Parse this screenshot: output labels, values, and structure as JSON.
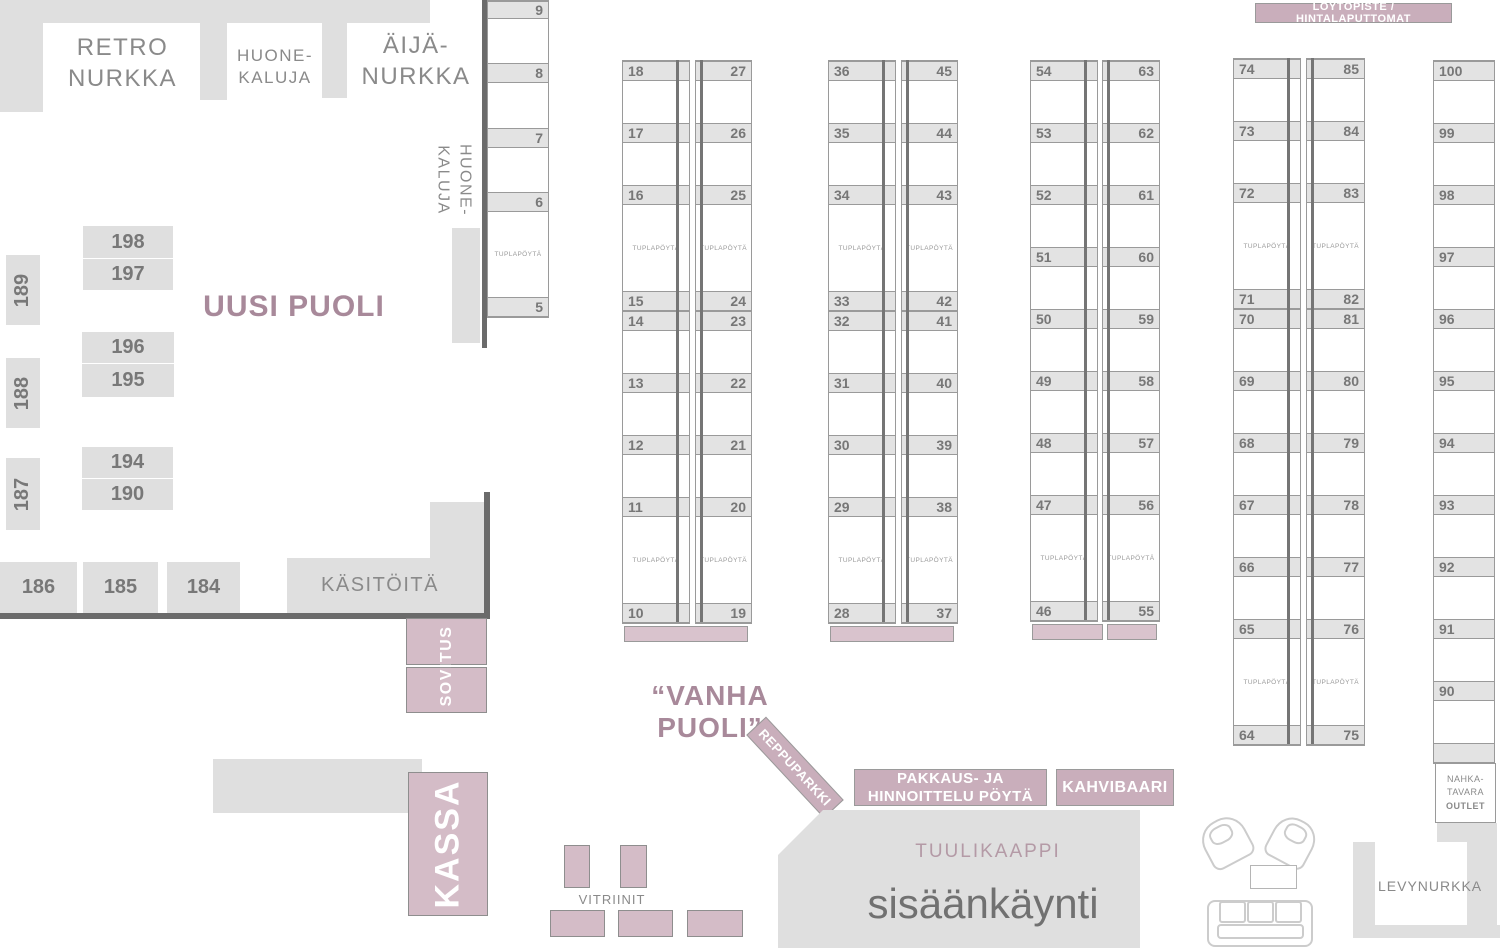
{
  "palette": {
    "pink_fill": "#d4bcc7",
    "badge_pink": "#c9aebb",
    "bar_pink": "#d9c3cd",
    "gray_fill": "#dfdfdf",
    "band_gray": "#e3e3e3",
    "line_gray": "#9a9a9a",
    "dark_wall": "#6b6b6b",
    "text_gray": "#8a8a8a",
    "mauve": "#a8899a"
  },
  "labels": {
    "retro": [
      "RETRO",
      "NURKKA"
    ],
    "huonekaluja_top": [
      "HUONE-",
      "KALUJA"
    ],
    "aija": [
      "ÄIJÄ-",
      "NURKKA"
    ],
    "huonekaluja_side": [
      "HUONE-",
      "KALUJA"
    ],
    "uusi_puoli": "UUSI PUOLI",
    "vanha_puoli": "“VANHA PUOLI”",
    "kasitoita": "KÄSITÖITÄ",
    "sovitus": "SOVITUS",
    "kassa": "KASSA",
    "vitriinit": "VITRIINIT",
    "reppuparkki": "REPPUPARKKI",
    "pakkaus": [
      "PAKKAUS- JA",
      "HINNOITTELU PÖYTÄ"
    ],
    "kahvibaari": "KAHVIBAARI",
    "tuulikaappi": "TUULIKAAPPI",
    "sisaankaynti": "sisäänkäynti",
    "loytopiste": "LÖYTÖPISTE / HINTALAPUTTOMAT",
    "nahka": [
      "NAHKA-",
      "TAVARA",
      "OUTLET"
    ],
    "levynurkka": "LEVYNURKKA"
  },
  "tupla_label": "TUPLAPÖYTÄ",
  "booths": {
    "vertical": [
      {
        "num": "189",
        "x": 6,
        "y": 255,
        "w": 34,
        "h": 70
      },
      {
        "num": "188",
        "x": 6,
        "y": 358,
        "w": 34,
        "h": 70
      },
      {
        "num": "187",
        "x": 6,
        "y": 458,
        "w": 34,
        "h": 72
      }
    ],
    "horizontal": [
      {
        "num": "198",
        "x": 83,
        "y": 226,
        "w": 90,
        "h": 32
      },
      {
        "num": "197",
        "x": 83,
        "y": 259,
        "w": 90,
        "h": 31
      },
      {
        "num": "196",
        "x": 82,
        "y": 332,
        "w": 92,
        "h": 31
      },
      {
        "num": "195",
        "x": 82,
        "y": 364,
        "w": 92,
        "h": 33
      },
      {
        "num": "194",
        "x": 82,
        "y": 447,
        "w": 91,
        "h": 31
      },
      {
        "num": "190",
        "x": 82,
        "y": 479,
        "w": 91,
        "h": 31
      },
      {
        "num": "186",
        "x": 0,
        "y": 562,
        "w": 77,
        "h": 51
      },
      {
        "num": "185",
        "x": 83,
        "y": 562,
        "w": 75,
        "h": 51
      },
      {
        "num": "184",
        "x": 167,
        "y": 562,
        "w": 73,
        "h": 51
      }
    ]
  },
  "table_columns": [
    {
      "name": "tables-5-9",
      "x": 487,
      "y": 0,
      "mode": "single-right",
      "colw": 60,
      "segments": [
        {
          "t": "b",
          "n": "9",
          "h": 18
        },
        {
          "t": "g",
          "h": 44
        },
        {
          "t": "b",
          "n": "8"
        },
        {
          "t": "g",
          "h": 45
        },
        {
          "t": "b",
          "n": "7"
        },
        {
          "t": "g",
          "h": 44
        },
        {
          "t": "b",
          "n": "6"
        },
        {
          "t": "d",
          "h": 85
        },
        {
          "t": "b",
          "n": "5"
        }
      ]
    },
    {
      "name": "tables-10-27",
      "x": 622,
      "y": 60,
      "mode": "double",
      "lw": 66,
      "gap": 7,
      "rw": 55,
      "segments": [
        {
          "t": "b",
          "l": "18",
          "r": "27"
        },
        {
          "t": "g"
        },
        {
          "t": "b",
          "l": "17",
          "r": "26"
        },
        {
          "t": "g"
        },
        {
          "t": "b",
          "l": "16",
          "r": "25"
        },
        {
          "t": "d"
        },
        {
          "t": "b",
          "l": "15",
          "r": "24"
        },
        {
          "t": "b",
          "l": "14",
          "r": "23"
        },
        {
          "t": "g"
        },
        {
          "t": "b",
          "l": "13",
          "r": "22"
        },
        {
          "t": "g"
        },
        {
          "t": "b",
          "l": "12",
          "r": "21"
        },
        {
          "t": "g"
        },
        {
          "t": "b",
          "l": "11",
          "r": "20"
        },
        {
          "t": "d"
        },
        {
          "t": "b",
          "l": "10",
          "r": "19"
        }
      ],
      "bars": [
        {
          "x": 2,
          "w": 124
        }
      ]
    },
    {
      "name": "tables-28-45",
      "x": 828,
      "y": 60,
      "mode": "double",
      "lw": 66,
      "gap": 7,
      "rw": 55,
      "segments": [
        {
          "t": "b",
          "l": "36",
          "r": "45"
        },
        {
          "t": "g"
        },
        {
          "t": "b",
          "l": "35",
          "r": "44"
        },
        {
          "t": "g"
        },
        {
          "t": "b",
          "l": "34",
          "r": "43"
        },
        {
          "t": "d"
        },
        {
          "t": "b",
          "l": "33",
          "r": "42"
        },
        {
          "t": "b",
          "l": "32",
          "r": "41"
        },
        {
          "t": "g"
        },
        {
          "t": "b",
          "l": "31",
          "r": "40"
        },
        {
          "t": "g"
        },
        {
          "t": "b",
          "l": "30",
          "r": "39"
        },
        {
          "t": "g"
        },
        {
          "t": "b",
          "l": "29",
          "r": "38"
        },
        {
          "t": "d"
        },
        {
          "t": "b",
          "l": "28",
          "r": "37"
        }
      ],
      "bars": [
        {
          "x": 2,
          "w": 124
        }
      ]
    },
    {
      "name": "tables-46-63",
      "x": 1030,
      "y": 60,
      "mode": "double",
      "lw": 66,
      "gap": 6,
      "rw": 56,
      "segments": [
        {
          "t": "b",
          "l": "54",
          "r": "63"
        },
        {
          "t": "g"
        },
        {
          "t": "b",
          "l": "53",
          "r": "62"
        },
        {
          "t": "g"
        },
        {
          "t": "b",
          "l": "52",
          "r": "61"
        },
        {
          "t": "g"
        },
        {
          "t": "b",
          "l": "51",
          "r": "60"
        },
        {
          "t": "g"
        },
        {
          "t": "b",
          "l": "50",
          "r": "59"
        },
        {
          "t": "g"
        },
        {
          "t": "b",
          "l": "49",
          "r": "58"
        },
        {
          "t": "g"
        },
        {
          "t": "b",
          "l": "48",
          "r": "57"
        },
        {
          "t": "g"
        },
        {
          "t": "b",
          "l": "47",
          "r": "56"
        },
        {
          "t": "d"
        },
        {
          "t": "b",
          "l": "46",
          "r": "55"
        }
      ],
      "bars": [
        {
          "x": 2,
          "w": 71
        },
        {
          "x": 77,
          "w": 50
        }
      ]
    },
    {
      "name": "tables-64-85",
      "x": 1233,
      "y": 58,
      "mode": "double",
      "lw": 66,
      "gap": 7,
      "rw": 57,
      "segments": [
        {
          "t": "b",
          "l": "74",
          "r": "85"
        },
        {
          "t": "g"
        },
        {
          "t": "b",
          "l": "73",
          "r": "84"
        },
        {
          "t": "g"
        },
        {
          "t": "b",
          "l": "72",
          "r": "83"
        },
        {
          "t": "d"
        },
        {
          "t": "b",
          "l": "71",
          "r": "82"
        },
        {
          "t": "b",
          "l": "70",
          "r": "81"
        },
        {
          "t": "g"
        },
        {
          "t": "b",
          "l": "69",
          "r": "80"
        },
        {
          "t": "g"
        },
        {
          "t": "b",
          "l": "68",
          "r": "79"
        },
        {
          "t": "g"
        },
        {
          "t": "b",
          "l": "67",
          "r": "78"
        },
        {
          "t": "g"
        },
        {
          "t": "b",
          "l": "66",
          "r": "77"
        },
        {
          "t": "g"
        },
        {
          "t": "b",
          "l": "65",
          "r": "76"
        },
        {
          "t": "d"
        },
        {
          "t": "b",
          "l": "64",
          "r": "75"
        }
      ]
    },
    {
      "name": "tables-90-100",
      "x": 1433,
      "y": 60,
      "mode": "single-left",
      "colw": 60,
      "segments": [
        {
          "t": "b",
          "n": "100"
        },
        {
          "t": "g"
        },
        {
          "t": "b",
          "n": "99"
        },
        {
          "t": "g"
        },
        {
          "t": "b",
          "n": "98"
        },
        {
          "t": "g"
        },
        {
          "t": "b",
          "n": "97"
        },
        {
          "t": "g"
        },
        {
          "t": "b",
          "n": "96"
        },
        {
          "t": "g"
        },
        {
          "t": "b",
          "n": "95"
        },
        {
          "t": "g"
        },
        {
          "t": "b",
          "n": "94"
        },
        {
          "t": "g"
        },
        {
          "t": "b",
          "n": "93"
        },
        {
          "t": "g"
        },
        {
          "t": "b",
          "n": "92"
        },
        {
          "t": "g"
        },
        {
          "t": "b",
          "n": "91"
        },
        {
          "t": "g"
        },
        {
          "t": "b",
          "n": "90"
        },
        {
          "t": "g"
        },
        {
          "t": "b",
          "n": ""
        }
      ]
    }
  ]
}
